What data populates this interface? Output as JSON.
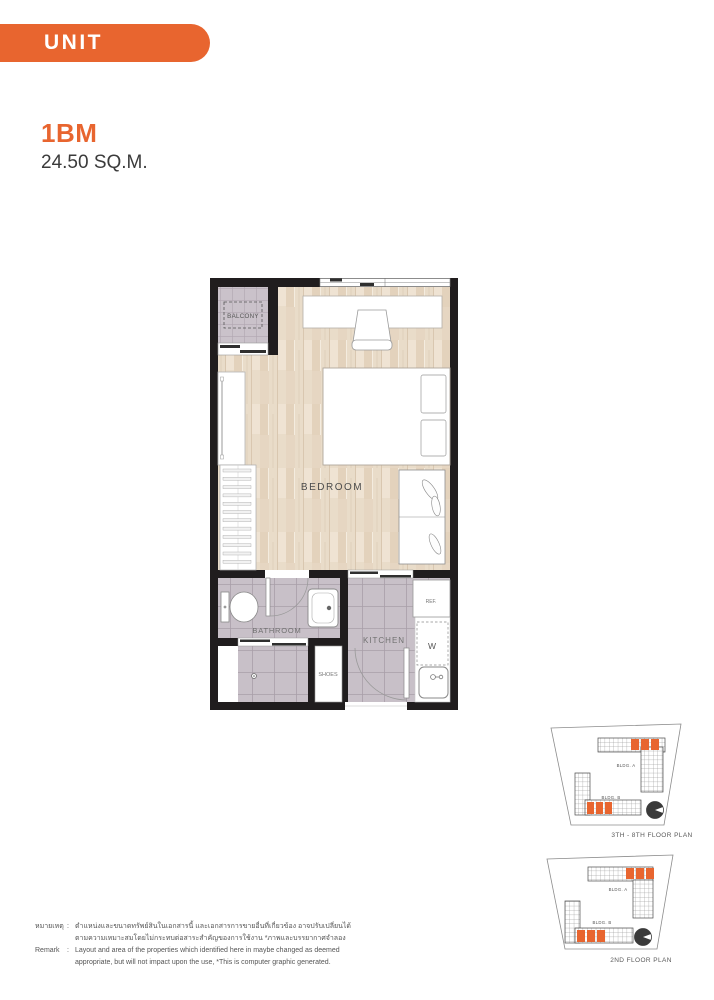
{
  "header": {
    "badge": "UNIT LAYOUT"
  },
  "unit": {
    "name": "1BM",
    "area": "24.50 SQ.M."
  },
  "floor_plan": {
    "balcony": "BALCONY",
    "bedroom": "BEDROOM",
    "bathroom": "BATHROOM",
    "kitchen": "KITCHEN",
    "shoes": "SHOES",
    "refrigerator": "REF.",
    "washer": "W"
  },
  "site_plans": [
    {
      "bldg_a": "BLDG. A",
      "bldg_b": "BLDG. B",
      "caption": "3TH - 8TH FLOOR PLAN"
    },
    {
      "bldg_a": "BLDG. A",
      "bldg_b": "BLDG. B",
      "caption": "2ND FLOOR PLAN"
    }
  ],
  "remark": {
    "colon": ":",
    "rows": [
      {
        "label": "หมายเหตุ",
        "lines": [
          "ตำแหน่งและขนาดทรัพย์สินในเอกสารนี้ และเอกสารการขายอื่นที่เกี่ยวข้อง อาจปรับเปลี่ยนได้",
          "ตามความเหมาะสมโดยไม่กระทบต่อสาระสำคัญของการใช้งาน *ภาพและบรรยากาศจำลอง"
        ]
      },
      {
        "label": "Remark",
        "lines": [
          "Layout and area of the properties which identified here in maybe changed as deemed",
          "appropriate, but will not impact upon the use, *This is computer graphic generated."
        ]
      }
    ]
  },
  "colors": {
    "accent": "#E8652F",
    "wall": "#201d1e",
    "tile": "#c8c0c8",
    "wood": "#e8dac6"
  }
}
